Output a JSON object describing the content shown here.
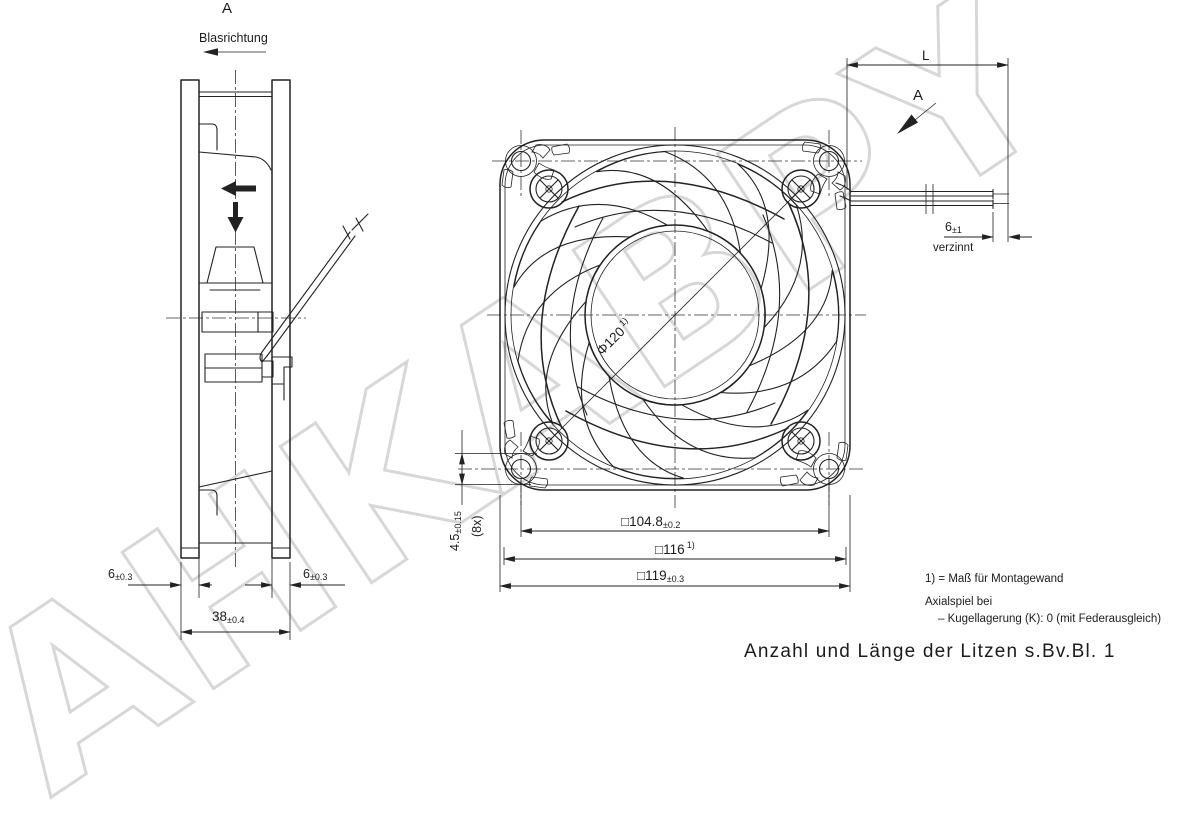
{
  "watermark": "AHKABPY",
  "labels": {
    "view_a_top": "A",
    "blasrichtung": "Blasrichtung",
    "view_a_right": "A",
    "length": "L",
    "verzinnt": "verzinnt"
  },
  "dims": {
    "flange_left": {
      "v": "6",
      "t": "±0.3"
    },
    "flange_right": {
      "v": "6",
      "t": "±0.3"
    },
    "depth": {
      "v": "38",
      "t": "±0.4"
    },
    "impeller": {
      "v": "Φ120",
      "sup": "1)"
    },
    "hole": {
      "v": "4.5",
      "t": "±0.15"
    },
    "hole_count": "(8x)",
    "hole_spacing": {
      "v": "□104.8",
      "t": "±0.2"
    },
    "mounting_wall": {
      "v": "□116",
      "sup": "1)"
    },
    "frame": {
      "v": "□119",
      "t": "±0.3"
    },
    "tinned_length": {
      "v": "6",
      "t": "±1"
    }
  },
  "notes": {
    "note1": "1) = Maß für Montagewand",
    "note2": "Axialspiel bei",
    "note3": "–  Kugellagerung (K): 0  (mit Federausgleich)",
    "litzen": "Anzahl und Länge der Litzen s.Bv.Bl. 1"
  }
}
